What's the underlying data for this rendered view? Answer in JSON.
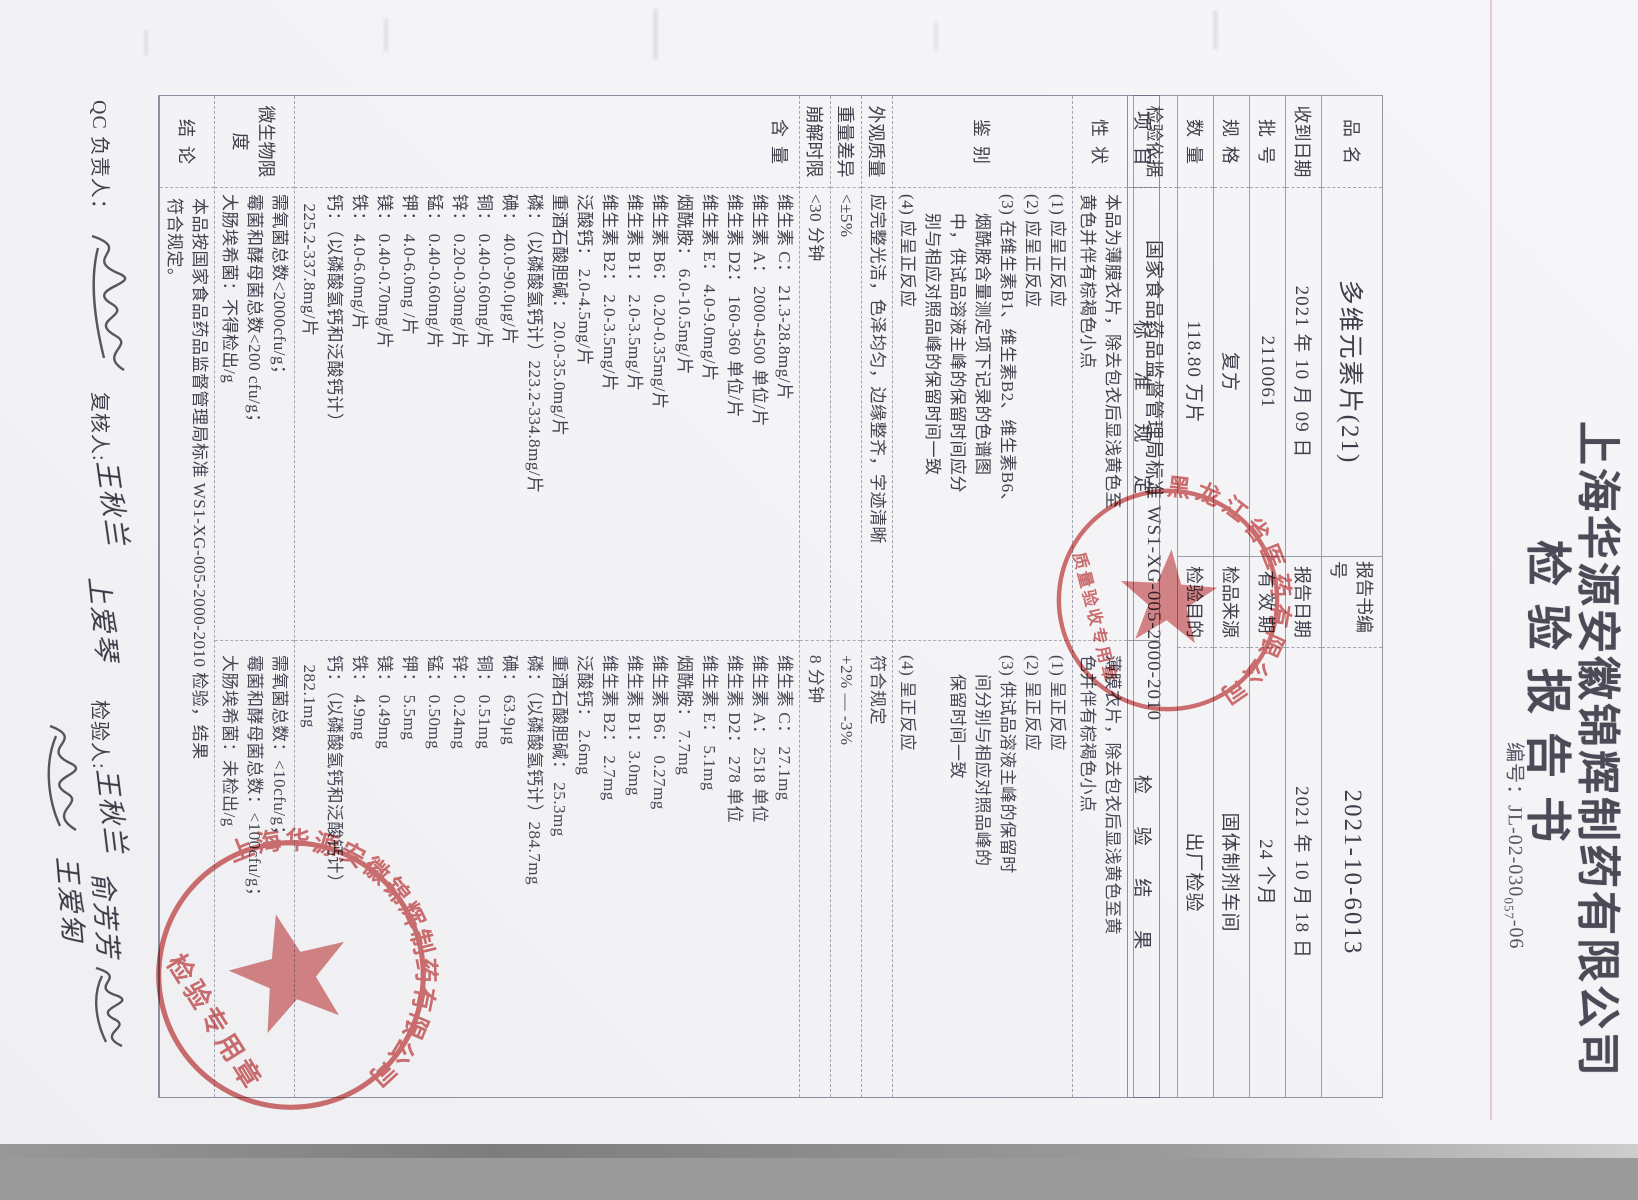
{
  "document": {
    "company": "上海华源安徽锦辉制药有限公司",
    "title": "检验报告书",
    "code_label": "编号：",
    "code": "JL-02-030",
    "code_sub": "057",
    "code_tail": "-06"
  },
  "info": {
    "rows": [
      {
        "l_label": "品  名",
        "l_value": "多维元素片(21)",
        "r_label": "报告书编号",
        "r_value": "2021-10-6013",
        "big": true
      },
      {
        "l_label": "收到日期",
        "l_value": "2021 年 10 月 09 日",
        "r_label": "报告日期",
        "r_value": "2021 年 10 月 18 日"
      },
      {
        "l_label": "批  号",
        "l_value": "2110061",
        "r_label": "有 效 期",
        "r_value": "24 个月"
      },
      {
        "l_label": "规  格",
        "l_value": "复方",
        "r_label": "检品来源",
        "r_value": "固体制剂车间"
      },
      {
        "l_label": "数  量",
        "l_value": "118.80 万片",
        "r_label": "检验目的",
        "r_value": "出厂检验"
      },
      {
        "l_label": "检验依据",
        "l_value": "国家食品药品监督管理局标准 WS1-XG-005-2000-2010",
        "span": true,
        "tall": true
      }
    ]
  },
  "table": {
    "headers": [
      "项  目",
      "标 准 规 定",
      "检 验 结 果"
    ],
    "rows": [
      {
        "item": "性  状",
        "std": [
          "本品为薄膜衣片，除去包衣后显浅黄色至",
          "黄色并伴有棕褐色小点"
        ],
        "res": [
          "薄膜衣片，除去包衣后显浅黄色至黄",
          "色并伴有棕褐色小点"
        ]
      },
      {
        "item": "鉴  别",
        "std": [
          "(1) 应呈正反应",
          "(2) 应呈正反应",
          "(3) 在维生素B1、维生素B2、维生素B6、",
          "    烟酰胺含量测定项下记录的色谱图",
          "    中，供试品溶液主峰的保留时间应分",
          "    别与相应对照品峰的保留时间一致",
          "(4) 应呈正反应"
        ],
        "res": [
          "(1) 呈正反应",
          "(2) 呈正反应",
          "(3) 供试品溶液主峰的保留时",
          "    间分别与相应对照品峰的",
          "    保留时间一致",
          "",
          "(4) 呈正反应"
        ]
      },
      {
        "item": "外观质量",
        "std": [
          "应完整光洁，色泽均匀，边缘整齐，字迹清晰"
        ],
        "res": [
          "符合规定"
        ]
      },
      {
        "item": "重量差异",
        "std": [
          "<±5%"
        ],
        "res": [
          "+2% — -3%"
        ]
      },
      {
        "item": "崩解时限",
        "std": [
          "<30 分钟"
        ],
        "res": [
          "8 分钟"
        ]
      },
      {
        "item": "含  量",
        "label_top": true,
        "std": [
          "维生素 C： 21.3-28.8mg/片",
          "维生素 A： 2000-4500 单位/片",
          "维生素 D2： 160-360 单位/片",
          "维生素 E： 4.0-9.0mg/片",
          "烟酰胺： 6.0-10.5mg/片",
          "维生素 B6： 0.20-0.35mg/片",
          "维生素 B1： 2.0-3.5mg/片",
          "维生素 B2： 2.0-3.5mg/片",
          "泛酸钙： 2.0-4.5mg/片",
          "重酒石酸胆碱： 20.0-35.0mg/片",
          "磷：（以磷酸氢钙计）223.2-334.8mg/片",
          "碘： 40.0-90.0μg/片",
          "铜： 0.40-0.60mg/片",
          "锌： 0.20-0.30mg/片",
          "锰： 0.40-0.60mg/片",
          "钾： 4.0-6.0mg /片",
          "镁： 0.40-0.70mg/片",
          "铁： 4.0-6.0mg/片",
          "钙：（以磷酸氢钙和泛酸钙计）",
          "  225.2-337.8mg/片"
        ],
        "res": [
          "维生素 C： 27.1mg",
          "维生素 A： 2518 单位",
          "维生素 D2： 278 单位",
          "维生素 E： 5.1mg",
          "烟酰胺： 7.7mg",
          "维生素 B6： 0.27mg",
          "维生素 B1：3.0mg",
          "维生素 B2： 2.7mg",
          "泛酸钙： 2.6mg",
          "重酒石酸胆碱： 25.3mg",
          "磷：（以磷酸氢钙计）284.7mg",
          "碘： 63.9μg",
          "铜： 0.51mg",
          "锌： 0.24mg",
          "锰： 0.50mg",
          "钾： 5.5mg",
          "镁： 0.49mg",
          "铁： 4.9mg",
          "钙：（以磷酸氢钙和泛酸钙计）",
          "  282.1mg"
        ]
      },
      {
        "item": "微生物限度",
        "std": [
          "需氧菌总数<2000cfu/g；",
          "霉菌和酵母菌总数<200 cfu/g；",
          "大肠埃希菌：不得检出/g"
        ],
        "res": [
          "需氧菌总数：<10cfu/g；",
          "霉菌和酵母菌总数：<100cfu/g；",
          "大肠埃希菌：未检出/g"
        ]
      },
      {
        "item": "结  论",
        "conclusion": [
          "本品按国家食品药品监督管理局标准 WS1-XG-005-2000-2010 检验，结果",
          "符合规定。"
        ]
      }
    ]
  },
  "signatures": {
    "qc_label": "QC 负责人：",
    "reviewer_label": "复核人:",
    "reviewer_name": "王秋兰",
    "reviewer_name2": "上爱琴",
    "inspector_label": "检验人:",
    "inspector_name": "王秋兰",
    "inspector_name2": "俞芳芳",
    "extra_name2": "王爱匊"
  },
  "stamps": {
    "top": {
      "arc_text": "黑龙江省医药有限公司",
      "inner_text": "质量验收专用章",
      "color": "#c94f4f"
    },
    "bottom": {
      "arc_text": "上海华源安徽锦辉制药有限公司",
      "inner_text": "检验专用章",
      "color": "#c94f4f"
    }
  }
}
